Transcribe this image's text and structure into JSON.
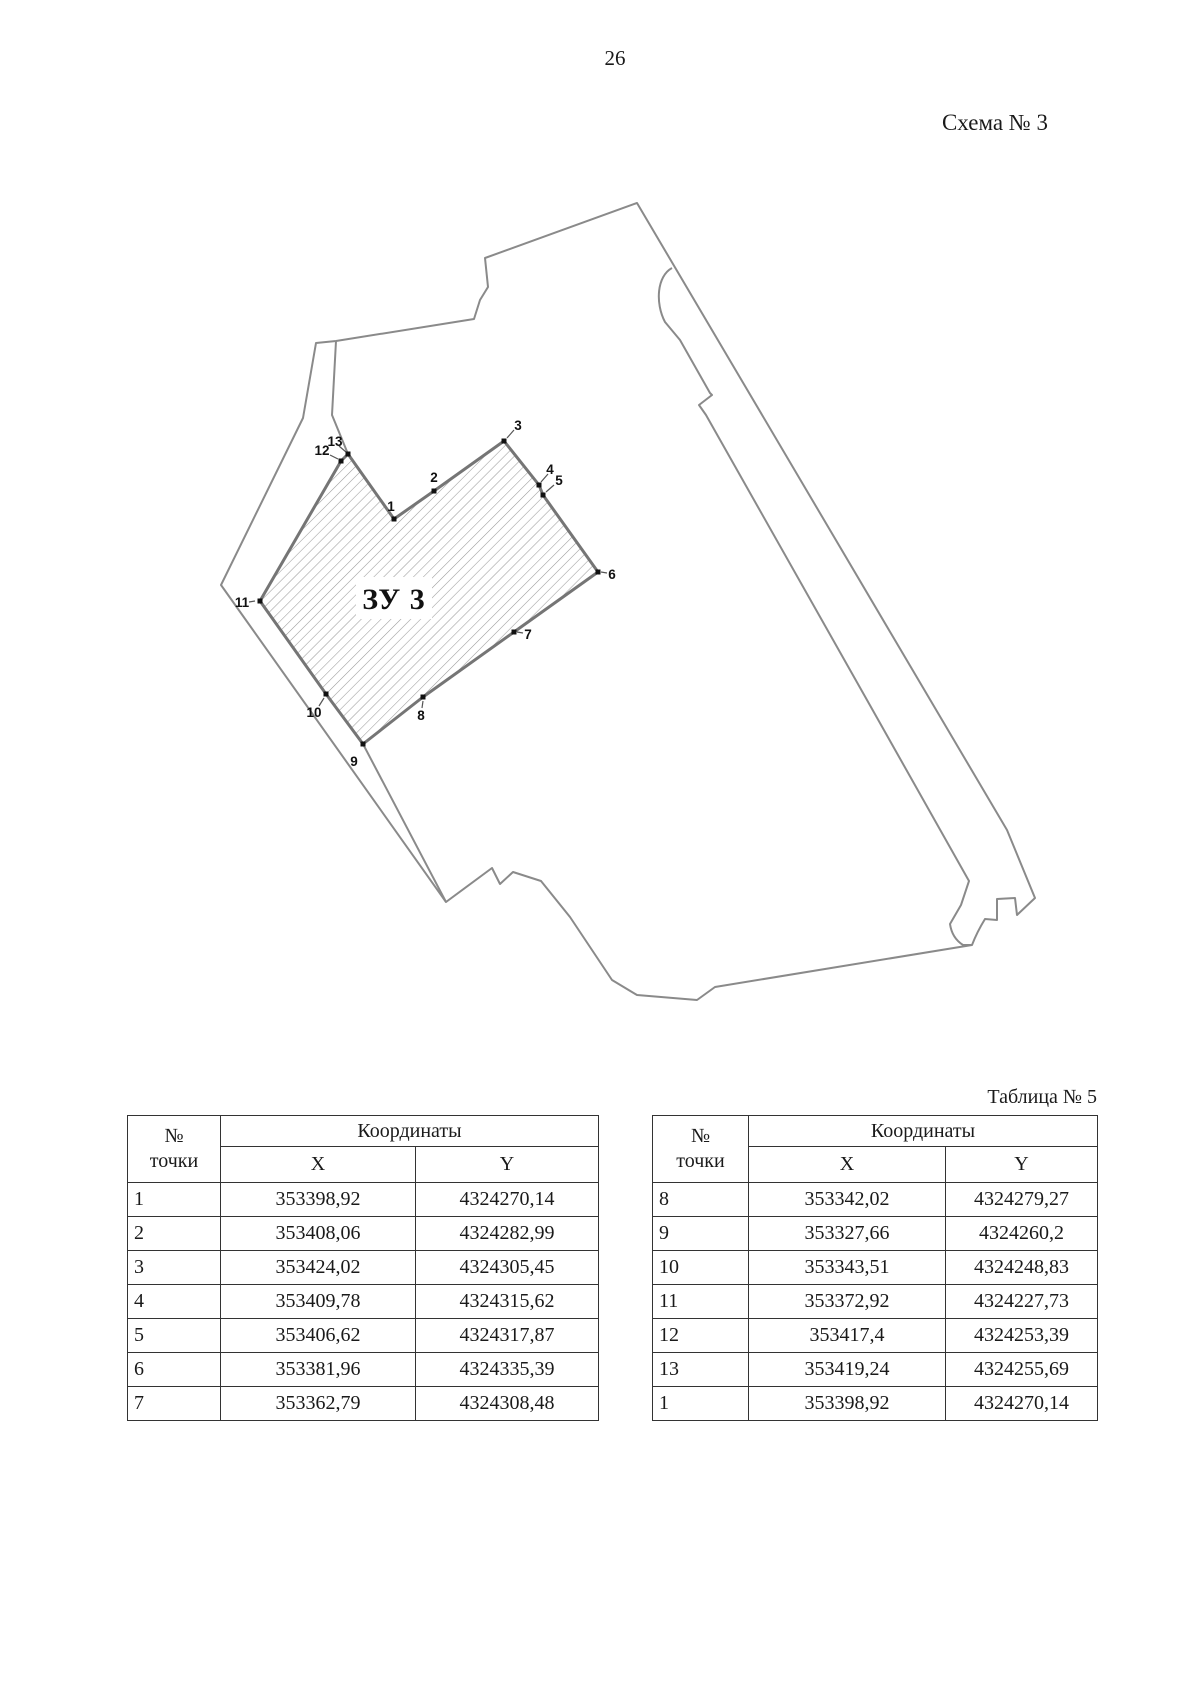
{
  "page": {
    "number": "26",
    "scheme_label": "Схема № 3",
    "table_label": "Таблица № 5"
  },
  "map": {
    "parcel_label": "ЗУ 3",
    "colors": {
      "outline": "#8a8a8a",
      "parcel_stroke": "#757575",
      "hatch": "#9b9b9b",
      "marker": "#111111",
      "leader": "#555555"
    },
    "points": [
      {
        "n": "1",
        "x": 394,
        "y": 519,
        "lx": 391,
        "ly": 506,
        "leader": null
      },
      {
        "n": "2",
        "x": 434,
        "y": 491,
        "lx": 434,
        "ly": 477,
        "leader": null
      },
      {
        "n": "3",
        "x": 504,
        "y": 441,
        "lx": 518,
        "ly": 425,
        "leader": [
          507,
          438,
          514,
          430
        ]
      },
      {
        "n": "4",
        "x": 539,
        "y": 485,
        "lx": 550,
        "ly": 469,
        "leader": [
          541,
          482,
          548,
          474
        ]
      },
      {
        "n": "5",
        "x": 543,
        "y": 495,
        "lx": 559,
        "ly": 480,
        "leader": [
          546,
          492,
          554,
          485
        ]
      },
      {
        "n": "6",
        "x": 598,
        "y": 572,
        "lx": 612,
        "ly": 574,
        "leader": [
          601,
          572,
          607,
          573
        ]
      },
      {
        "n": "7",
        "x": 514,
        "y": 632,
        "lx": 528,
        "ly": 634,
        "leader": [
          517,
          632,
          523,
          633
        ]
      },
      {
        "n": "8",
        "x": 423,
        "y": 697,
        "lx": 421,
        "ly": 715,
        "leader": [
          423,
          701,
          422,
          708
        ]
      },
      {
        "n": "9",
        "x": 363,
        "y": 744,
        "lx": 354,
        "ly": 761,
        "leader": null
      },
      {
        "n": "10",
        "x": 326,
        "y": 694,
        "lx": 314,
        "ly": 712,
        "leader": [
          324,
          698,
          319,
          706
        ]
      },
      {
        "n": "11",
        "x": 260,
        "y": 601,
        "lx": 242,
        "ly": 602,
        "leader": [
          249,
          602,
          255,
          601
        ]
      },
      {
        "n": "12",
        "x": 341,
        "y": 461,
        "lx": 322,
        "ly": 450,
        "leader": [
          330,
          455,
          338,
          459
        ]
      },
      {
        "n": "13",
        "x": 348,
        "y": 454,
        "lx": 335,
        "ly": 441,
        "leader": [
          339,
          446,
          346,
          452
        ]
      }
    ]
  },
  "tables": [
    {
      "header": {
        "point_line1": "№",
        "point_line2": "точки",
        "coords": "Координаты",
        "x": "X",
        "y": "Y"
      },
      "rows": [
        [
          "1",
          "353398,92",
          "4324270,14"
        ],
        [
          "2",
          "353408,06",
          "4324282,99"
        ],
        [
          "3",
          "353424,02",
          "4324305,45"
        ],
        [
          "4",
          "353409,78",
          "4324315,62"
        ],
        [
          "5",
          "353406,62",
          "4324317,87"
        ],
        [
          "6",
          "353381,96",
          "4324335,39"
        ],
        [
          "7",
          "353362,79",
          "4324308,48"
        ]
      ]
    },
    {
      "header": {
        "point_line1": "№",
        "point_line2": "точки",
        "coords": "Координаты",
        "x": "X",
        "y": "Y"
      },
      "rows": [
        [
          "8",
          "353342,02",
          "4324279,27"
        ],
        [
          "9",
          "353327,66",
          "4324260,2"
        ],
        [
          "10",
          "353343,51",
          "4324248,83"
        ],
        [
          "11",
          "353372,92",
          "4324227,73"
        ],
        [
          "12",
          "353417,4",
          "4324253,39"
        ],
        [
          "13",
          "353419,24",
          "4324255,69"
        ],
        [
          "1",
          "353398,92",
          "4324270,14"
        ]
      ]
    }
  ]
}
